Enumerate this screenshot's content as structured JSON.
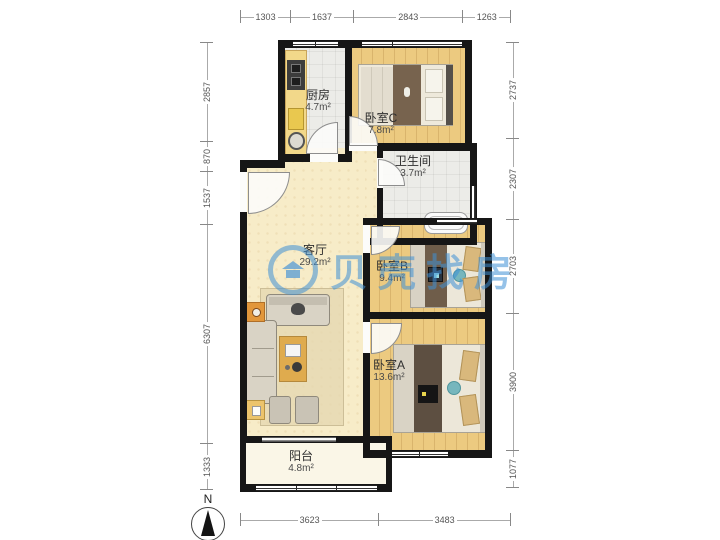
{
  "floorplan": {
    "watermark": {
      "text": "贝壳找房",
      "color": "#4394da"
    },
    "compass": {
      "label": "N"
    },
    "rooms": {
      "kitchen": {
        "name": "厨房",
        "area": "4.7m²"
      },
      "bedroom_c": {
        "name": "卧室C",
        "area": "7.8m²"
      },
      "bathroom": {
        "name": "卫生间",
        "area": "3.7m²"
      },
      "living_room": {
        "name": "客厅",
        "area": "29.2m²"
      },
      "bedroom_b": {
        "name": "卧室B",
        "area": "9.4m²"
      },
      "bedroom_a": {
        "name": "卧室A",
        "area": "13.6m²"
      },
      "balcony": {
        "name": "阳台",
        "area": "4.8m²"
      }
    },
    "dimensions_mm": {
      "top": [
        "1303",
        "1637",
        "2843",
        "1263"
      ],
      "bottom": [
        "3623",
        "3483"
      ],
      "left": [
        "2857",
        "870",
        "1537",
        "6307",
        "1333"
      ],
      "right": [
        "2737",
        "2307",
        "2703",
        "3900",
        "1077"
      ]
    },
    "colors": {
      "wall": "#161616",
      "wood_floor": "#ecca80",
      "tile_floor": "#ececE8",
      "living_floor": "#f7ecc8",
      "balcony_floor": "#faf6e7",
      "watermark_blue": "#4394da"
    }
  }
}
